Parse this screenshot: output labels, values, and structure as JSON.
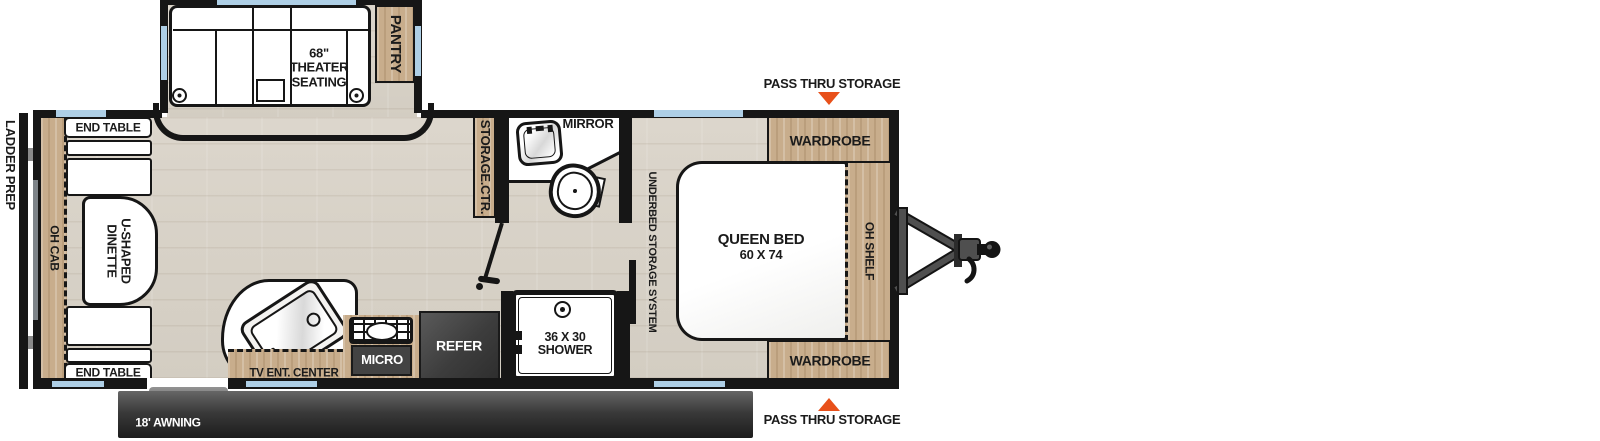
{
  "colors": {
    "wall": "#161616",
    "floor": "#d8d2c7",
    "wood": "#c8ad8c",
    "window": "#aecfe6",
    "appliance": "#414141",
    "accent_orange": "#e8501a",
    "text": "#1b1b1b"
  },
  "exterior": {
    "ladder_prep_label": "LADDER PREP",
    "entry_label": "ENTRY",
    "awning_label": "18' AWNING",
    "pass_thru_top_label": "PASS THRU STORAGE",
    "pass_thru_bottom_label": "PASS THRU STORAGE"
  },
  "slide_out": {
    "theater_label": "68\" THEATER SEATING",
    "pantry_label": "PANTRY"
  },
  "dinette": {
    "end_table_top_label": "END TABLE",
    "end_table_bottom_label": "END TABLE",
    "oh_cab_label": "OH CAB",
    "table_label": "U-SHAPED DINETTE"
  },
  "kitchen": {
    "tv_center_label": "TV ENT. CENTER",
    "micro_label": "MICRO",
    "refer_label": "REFER"
  },
  "bathroom": {
    "storage_ctr_label": "STORAGE.CTR.",
    "mirror_label": "MIRROR",
    "shower_size": "36 X 30",
    "shower_label": "SHOWER"
  },
  "bedroom": {
    "underbed_label": "UNDERBED STORAGE SYSTEM",
    "bed_label": "QUEEN BED",
    "bed_size": "60 X 74",
    "oh_shelf_label": "OH SHELF",
    "wardrobe_top_label": "WARDROBE",
    "wardrobe_bottom_label": "WARDROBE"
  }
}
